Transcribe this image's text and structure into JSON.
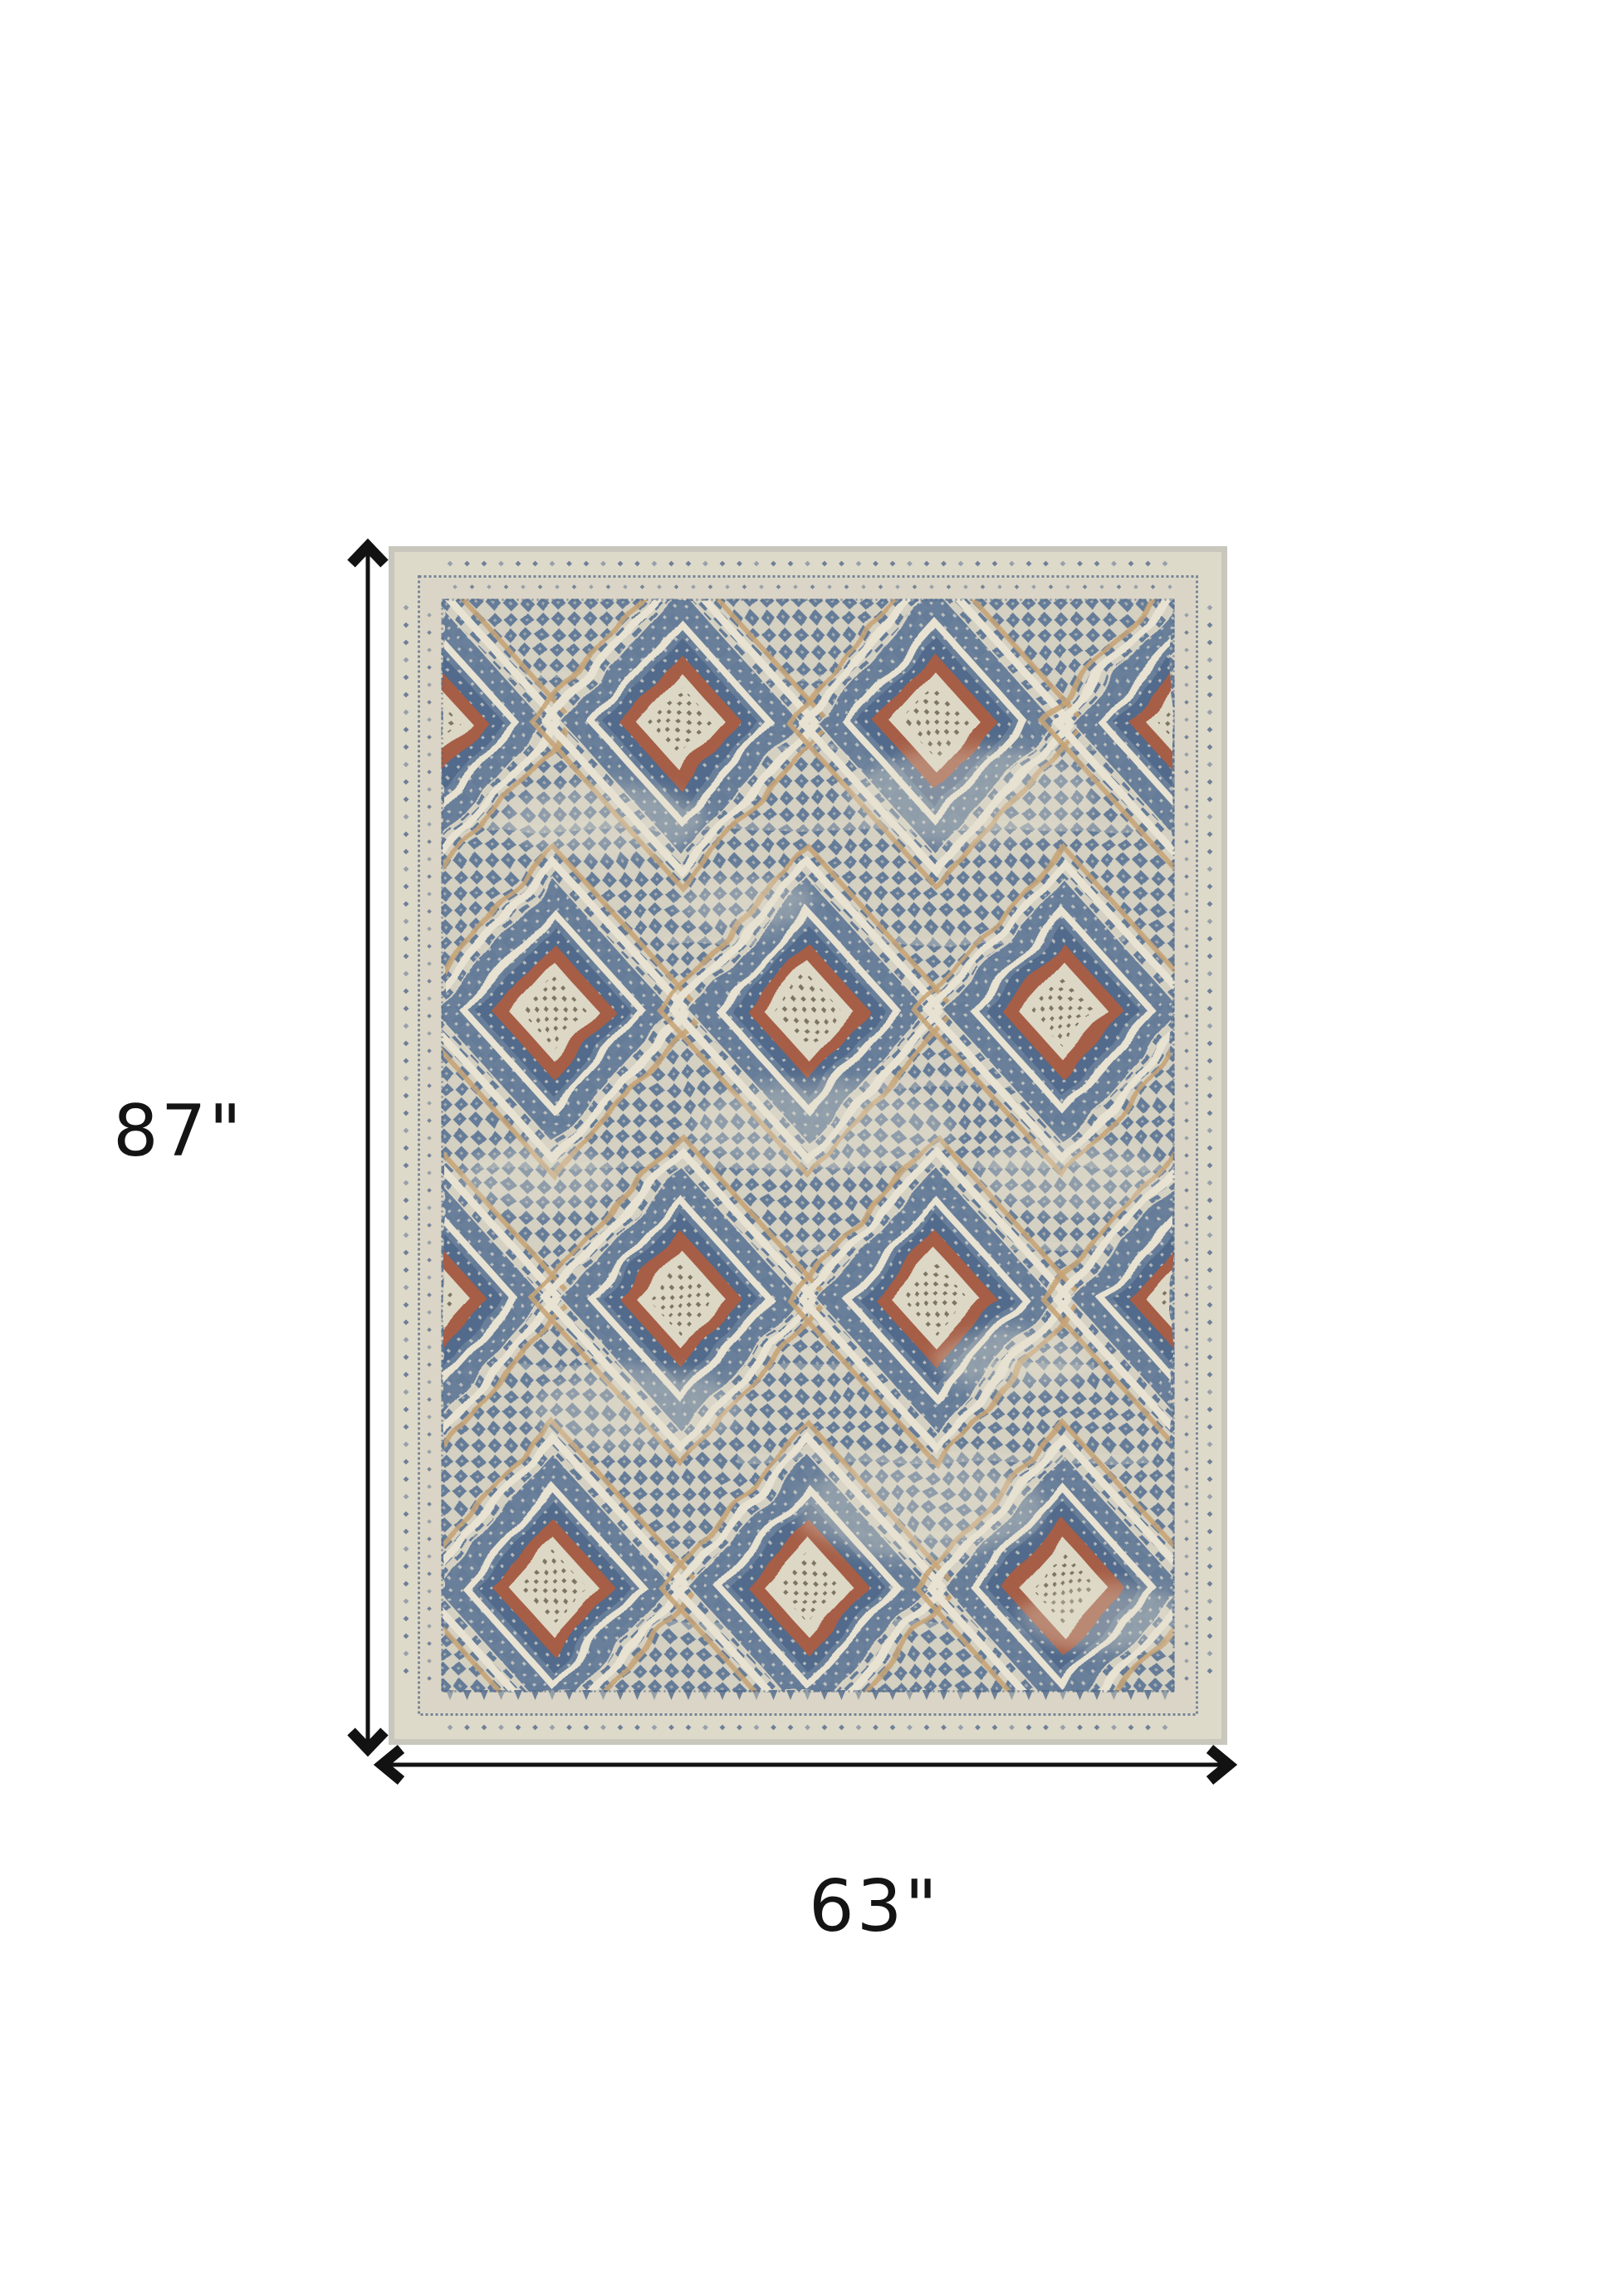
{
  "page": {
    "background": "#ffffff"
  },
  "dimensions": {
    "height_label": "87\"",
    "width_label": "63\"",
    "arrow_color": "#121212",
    "label_color": "#141414"
  },
  "rug": {
    "name": "distressed-diamond-medallion-area-rug",
    "palette": {
      "selvage": "#c7c4ba",
      "ivory": "#ddd8c8",
      "ivory_light": "#e7e1d0",
      "band2": "#d8d3c3",
      "cream": "#d2cebf",
      "field_blue": "#5d7593",
      "dark_blue": "#476184",
      "navy": "#41587a",
      "motif_blue": "#53698a",
      "tan": "#c49f6f",
      "rust": "#a2573e",
      "center_bg": "#dcd5c2",
      "center_dot": "#645c49",
      "distress": "#e3decd"
    }
  }
}
